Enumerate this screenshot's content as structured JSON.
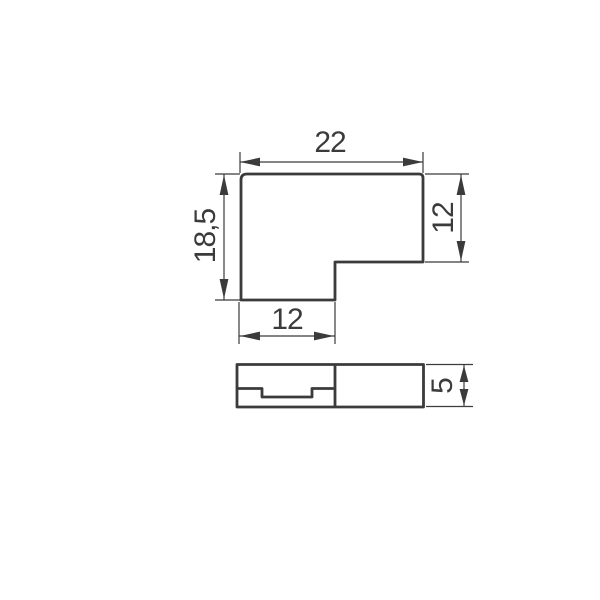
{
  "drawing": {
    "background_color": "#ffffff",
    "line_color": "#3b3b3b",
    "dimensions": {
      "top_width": "22",
      "left_height": "18,5",
      "right_height": "12",
      "bottom_width": "12",
      "side_height": "5"
    }
  }
}
